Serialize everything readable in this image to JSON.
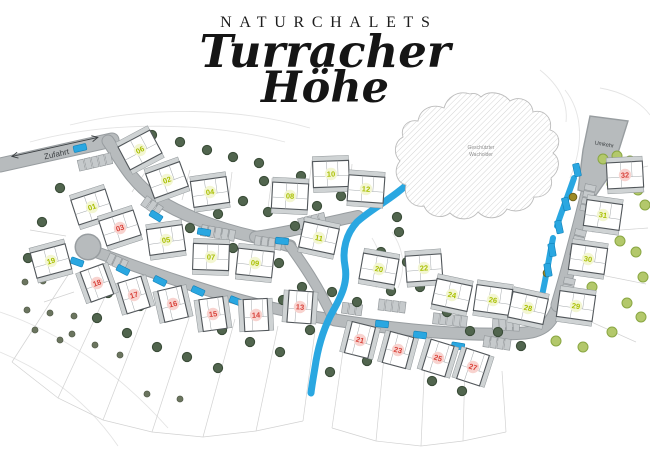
{
  "title": {
    "brand": "NATURCHALETS",
    "script_line1": "Turracher",
    "script_line2": "Höhe"
  },
  "labels": {
    "access_road": "Zufahrt",
    "turnaround": "Umkehr",
    "protected_area": [
      "Geschützter",
      "Wacholder"
    ]
  },
  "colors": {
    "road": "#b7bbbd",
    "road_edge": "#989da0",
    "water": "#2aa7e1",
    "available_number": "#a9bf00",
    "available_bg": "#f3f6d2",
    "reserved_number": "#d8423a",
    "reserved_bg": "#f8d3cf",
    "tree_dark": "#51654e",
    "tree_light": "#b3c86b"
  },
  "map": {
    "houses": [
      {
        "num": "01",
        "x": 92,
        "y": 207,
        "rot": -18,
        "color": "yellow",
        "portrait": false
      },
      {
        "num": "02",
        "x": 167,
        "y": 180,
        "rot": -20,
        "color": "yellow",
        "portrait": false
      },
      {
        "num": "03",
        "x": 120,
        "y": 228,
        "rot": -18,
        "color": "red",
        "portrait": false
      },
      {
        "num": "04",
        "x": 210,
        "y": 192,
        "rot": -8,
        "color": "yellow",
        "portrait": false
      },
      {
        "num": "05",
        "x": 166,
        "y": 240,
        "rot": -8,
        "color": "yellow",
        "portrait": false
      },
      {
        "num": "06",
        "x": 140,
        "y": 150,
        "rot": -28,
        "color": "yellow",
        "portrait": false
      },
      {
        "num": "07",
        "x": 211,
        "y": 257,
        "rot": 2,
        "color": "yellow",
        "portrait": false
      },
      {
        "num": "08",
        "x": 290,
        "y": 196,
        "rot": 3,
        "color": "yellow",
        "portrait": false
      },
      {
        "num": "09",
        "x": 255,
        "y": 263,
        "rot": 6,
        "color": "yellow",
        "portrait": false
      },
      {
        "num": "10",
        "x": 331,
        "y": 174,
        "rot": -2,
        "color": "yellow",
        "portrait": false
      },
      {
        "num": "11",
        "x": 319,
        "y": 238,
        "rot": 12,
        "color": "yellow",
        "portrait": false
      },
      {
        "num": "12",
        "x": 366,
        "y": 189,
        "rot": 4,
        "color": "yellow",
        "portrait": false
      },
      {
        "num": "13",
        "x": 300,
        "y": 307,
        "rot": 4,
        "color": "red",
        "portrait": true
      },
      {
        "num": "14",
        "x": 256,
        "y": 315,
        "rot": -3,
        "color": "red",
        "portrait": true
      },
      {
        "num": "15",
        "x": 213,
        "y": 314,
        "rot": -8,
        "color": "red",
        "portrait": true
      },
      {
        "num": "16",
        "x": 173,
        "y": 304,
        "rot": -13,
        "color": "red",
        "portrait": true
      },
      {
        "num": "17",
        "x": 134,
        "y": 295,
        "rot": -17,
        "color": "red",
        "portrait": true
      },
      {
        "num": "18",
        "x": 97,
        "y": 283,
        "rot": -20,
        "color": "red",
        "portrait": true
      },
      {
        "num": "19",
        "x": 51,
        "y": 261,
        "rot": -15,
        "color": "yellow",
        "portrait": false
      },
      {
        "num": "20",
        "x": 379,
        "y": 269,
        "rot": 10,
        "color": "yellow",
        "portrait": false
      },
      {
        "num": "21",
        "x": 360,
        "y": 340,
        "rot": 14,
        "color": "red",
        "portrait": true
      },
      {
        "num": "22",
        "x": 424,
        "y": 268,
        "rot": -4,
        "color": "yellow",
        "portrait": false
      },
      {
        "num": "23",
        "x": 398,
        "y": 350,
        "rot": 15,
        "color": "red",
        "portrait": true
      },
      {
        "num": "24",
        "x": 452,
        "y": 295,
        "rot": 12,
        "color": "yellow",
        "portrait": false
      },
      {
        "num": "25",
        "x": 438,
        "y": 358,
        "rot": 17,
        "color": "red",
        "portrait": true
      },
      {
        "num": "26",
        "x": 493,
        "y": 300,
        "rot": 8,
        "color": "yellow",
        "portrait": false
      },
      {
        "num": "27",
        "x": 473,
        "y": 367,
        "rot": 18,
        "color": "red",
        "portrait": true
      },
      {
        "num": "28",
        "x": 528,
        "y": 308,
        "rot": 12,
        "color": "yellow",
        "portrait": false
      },
      {
        "num": "29",
        "x": 576,
        "y": 306,
        "rot": 8,
        "color": "yellow",
        "portrait": false
      },
      {
        "num": "30",
        "x": 588,
        "y": 259,
        "rot": 8,
        "color": "yellow",
        "portrait": false
      },
      {
        "num": "31",
        "x": 603,
        "y": 215,
        "rot": 8,
        "color": "yellow",
        "portrait": false
      },
      {
        "num": "32",
        "x": 625,
        "y": 175,
        "rot": -3,
        "color": "red",
        "portrait": false
      }
    ],
    "parking_rows": [
      [
        95,
        162,
        -13,
        5
      ],
      [
        152,
        206,
        35,
        3
      ],
      [
        218,
        233,
        10,
        5
      ],
      [
        268,
        243,
        8,
        4
      ],
      [
        312,
        221,
        -14,
        4
      ],
      [
        352,
        309,
        8,
        3
      ],
      [
        392,
        306,
        7,
        4
      ],
      [
        450,
        320,
        6,
        5
      ],
      [
        506,
        325,
        3,
        4
      ],
      [
        588,
        198,
        -78,
        4
      ],
      [
        578,
        243,
        -76,
        4
      ],
      [
        568,
        288,
        -78,
        3
      ],
      [
        117,
        262,
        25,
        3
      ],
      [
        497,
        343,
        8,
        4
      ]
    ],
    "cars": [
      [
        80,
        148,
        -13
      ],
      [
        156,
        216,
        32
      ],
      [
        204,
        232,
        10
      ],
      [
        282,
        241,
        6
      ],
      [
        331,
        229,
        -14
      ],
      [
        123,
        270,
        27
      ],
      [
        160,
        281,
        26
      ],
      [
        198,
        291,
        24
      ],
      [
        236,
        301,
        22
      ],
      [
        77,
        262,
        20
      ],
      [
        382,
        324,
        6
      ],
      [
        420,
        335,
        7
      ],
      [
        458,
        346,
        9
      ],
      [
        577,
        170,
        78
      ],
      [
        566,
        204,
        76
      ],
      [
        559,
        227,
        78
      ],
      [
        552,
        250,
        80
      ],
      [
        548,
        270,
        80
      ]
    ],
    "trees_dark": [
      [
        152,
        135
      ],
      [
        180,
        142
      ],
      [
        207,
        150
      ],
      [
        233,
        157
      ],
      [
        259,
        163
      ],
      [
        60,
        188
      ],
      [
        42,
        222
      ],
      [
        28,
        258
      ],
      [
        108,
        293
      ],
      [
        140,
        306
      ],
      [
        157,
        347
      ],
      [
        187,
        357
      ],
      [
        222,
        330
      ],
      [
        250,
        342
      ],
      [
        280,
        352
      ],
      [
        218,
        368
      ],
      [
        310,
        330
      ],
      [
        190,
        228
      ],
      [
        218,
        214
      ],
      [
        243,
        201
      ],
      [
        268,
        212
      ],
      [
        295,
        226
      ],
      [
        317,
        206
      ],
      [
        341,
        196
      ],
      [
        301,
        176
      ],
      [
        264,
        181
      ],
      [
        233,
        248
      ],
      [
        279,
        263
      ],
      [
        302,
        287
      ],
      [
        332,
        292
      ],
      [
        357,
        302
      ],
      [
        381,
        252
      ],
      [
        399,
        232
      ],
      [
        391,
        291
      ],
      [
        420,
        287
      ],
      [
        447,
        312
      ],
      [
        470,
        331
      ],
      [
        498,
        332
      ],
      [
        521,
        346
      ],
      [
        432,
        381
      ],
      [
        462,
        391
      ],
      [
        352,
        341
      ],
      [
        367,
        361
      ],
      [
        330,
        372
      ],
      [
        375,
        191
      ],
      [
        397,
        217
      ],
      [
        283,
        300
      ],
      [
        127,
        333
      ],
      [
        97,
        318
      ],
      [
        407,
        262
      ]
    ],
    "trees_light": [
      [
        603,
        159
      ],
      [
        617,
        156
      ],
      [
        630,
        161
      ],
      [
        612,
        184
      ],
      [
        638,
        190
      ],
      [
        645,
        205
      ],
      [
        620,
        241
      ],
      [
        636,
        252
      ],
      [
        592,
        287
      ],
      [
        627,
        303
      ],
      [
        641,
        317
      ],
      [
        612,
        332
      ],
      [
        583,
        347
      ],
      [
        556,
        341
      ],
      [
        643,
        277
      ]
    ],
    "bushes": [
      [
        25,
        282
      ],
      [
        43,
        281
      ],
      [
        27,
        310
      ],
      [
        50,
        313
      ],
      [
        74,
        316
      ],
      [
        72,
        334
      ],
      [
        95,
        345
      ],
      [
        120,
        355
      ],
      [
        60,
        340
      ],
      [
        35,
        330
      ],
      [
        147,
        394
      ],
      [
        180,
        399
      ]
    ],
    "gold_shrubs": [
      [
        573,
        197
      ],
      [
        547,
        273
      ]
    ]
  }
}
